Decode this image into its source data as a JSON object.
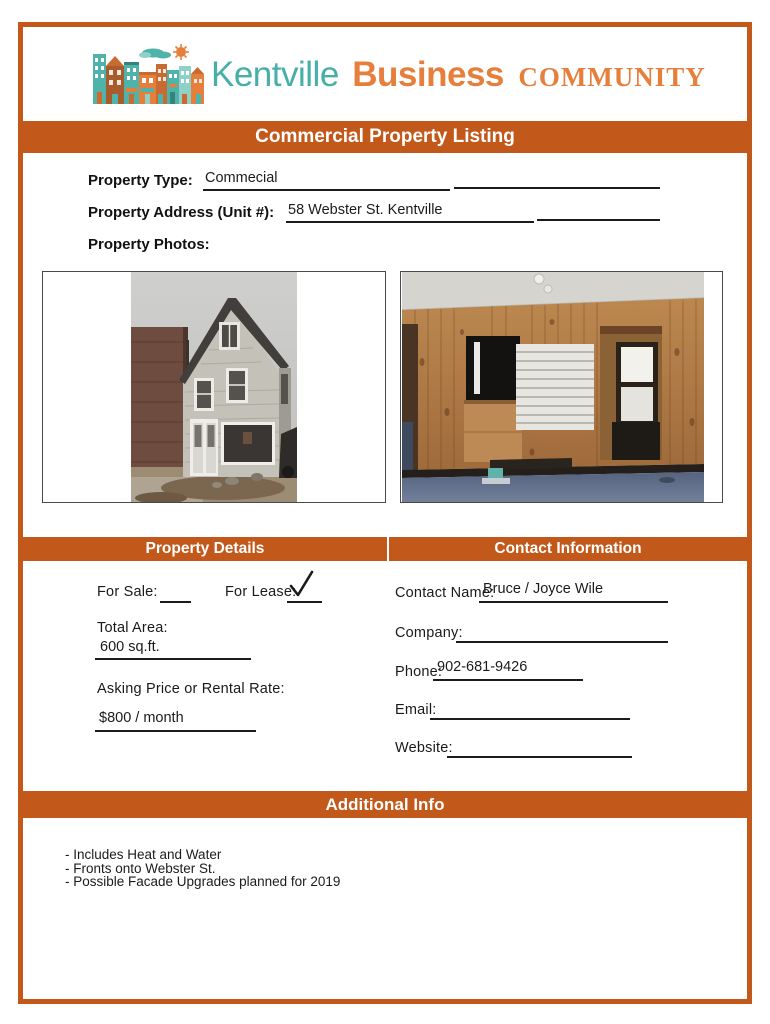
{
  "logo": {
    "kentville": "Kentville",
    "business": "Business",
    "community": "COMMUNITY",
    "illustration": "row-of-storefront-houses-with-cloud-and-sun"
  },
  "colors": {
    "accent_orange": "#C2591B",
    "logo_teal": "#48AFA7",
    "logo_orange": "#E67E3C"
  },
  "title_banner": "Commercial Property Listing",
  "form": {
    "property_type_label": "Property Type:",
    "property_type_value": "Commecial",
    "property_address_label": "Property Address (Unit #):",
    "property_address_value": "58 Webster St. Kentville",
    "property_photos_label": "Property Photos:"
  },
  "photos": [
    {
      "name": "exterior-house-photo"
    },
    {
      "name": "interior-wood-panel-photo"
    }
  ],
  "sections": {
    "property_details": "Property Details",
    "contact_information": "Contact Information",
    "additional_info": "Additional Info"
  },
  "property_details": {
    "for_sale_label": "For Sale:",
    "for_sale_value": "",
    "for_lease_label": "For Lease:",
    "for_lease_checked": true,
    "total_area_label": "Total Area:",
    "total_area_value": "600 sq.ft.",
    "asking_price_label": "Asking Price or Rental Rate:",
    "asking_price_value": "$800 / month"
  },
  "contact": {
    "contact_name_label": "Contact Name:",
    "contact_name_value": "Bruce / Joyce Wile",
    "company_label": "Company:",
    "company_value": "",
    "phone_label": "Phone:",
    "phone_value": "902-681-9426",
    "email_label": "Email:",
    "email_value": "",
    "website_label": "Website:",
    "website_value": ""
  },
  "additional_info_lines": [
    "- Includes Heat and Water",
    "- Fronts onto Webster St.",
    "- Possible Facade Upgrades planned for 2019"
  ]
}
